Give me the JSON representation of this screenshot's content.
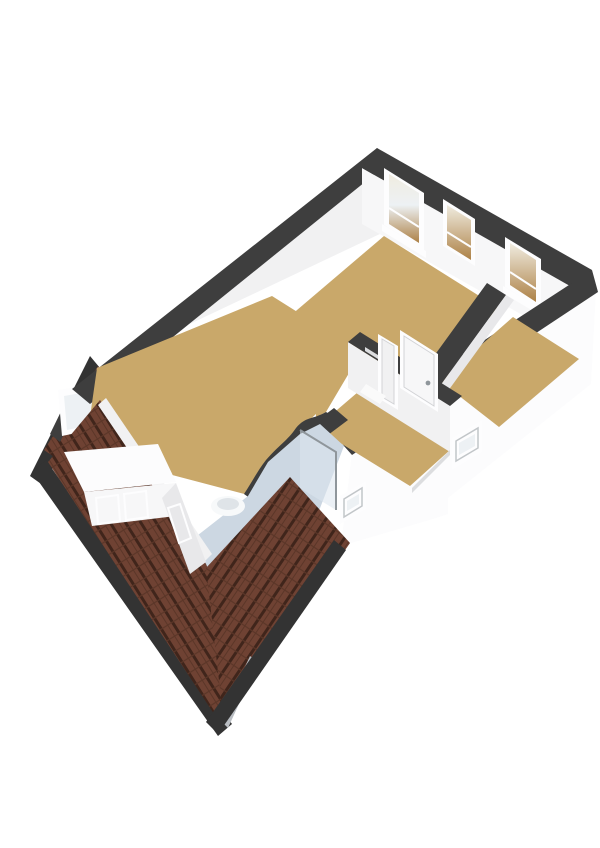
{
  "canvas": {
    "width": 600,
    "height": 848,
    "background": "#ffffff"
  },
  "colors": {
    "background": "#ffffff",
    "wall_cap": "#3e3e3e",
    "wall_cap_deep": "#2f2f2f",
    "fascia": "#333333",
    "wall_bright": "#fcfcfd",
    "wall_white": "#f7f7f8",
    "wall_light": "#f1f1f2",
    "wall_mid": "#e8e8ea",
    "wall_shade": "#dcdddf",
    "wall_deep": "#cfd0d3",
    "floor_wood": "#c9a86a",
    "floor_wood_deep": "#bd9a5c",
    "floor_bath": "#ccd7e2",
    "roof_base": "#6f4233",
    "roof_dark": "#40251b",
    "roof_mid": "#5b3628",
    "roof_ridge": "#b9bdc2",
    "glass": "#edf1f4",
    "glass_tan_top": "#f0ece0",
    "glass_tan_bottom": "#ad8146",
    "frame": "#fdfdfe",
    "handle": "#8f969b",
    "fixture": "#f7f9fa",
    "fixture_shade": "#dfe4e8",
    "shower_glass": "#dce6ee",
    "threshold": "#fafafa"
  },
  "scene": {
    "view": "3d-floorplan-isometric",
    "level": "attic-floor",
    "rooms": [
      {
        "name": "bedroom-rear",
        "floor": "wood"
      },
      {
        "name": "bedroom-right",
        "floor": "wood"
      },
      {
        "name": "landing-hall",
        "floor": "wood"
      },
      {
        "name": "bedroom-left",
        "floor": "wood"
      },
      {
        "name": "bathroom",
        "floor": "bath-tile"
      }
    ],
    "fixtures": [
      "washbasin",
      "toilet",
      "shower-screen"
    ],
    "features": [
      "dormer-with-windows",
      "sloped-roof-left",
      "sloped-roof-front",
      "roof-hip-ridge",
      "rear-wall-windows",
      "facade-small-windows",
      "interior-doors",
      "corner-window"
    ]
  }
}
